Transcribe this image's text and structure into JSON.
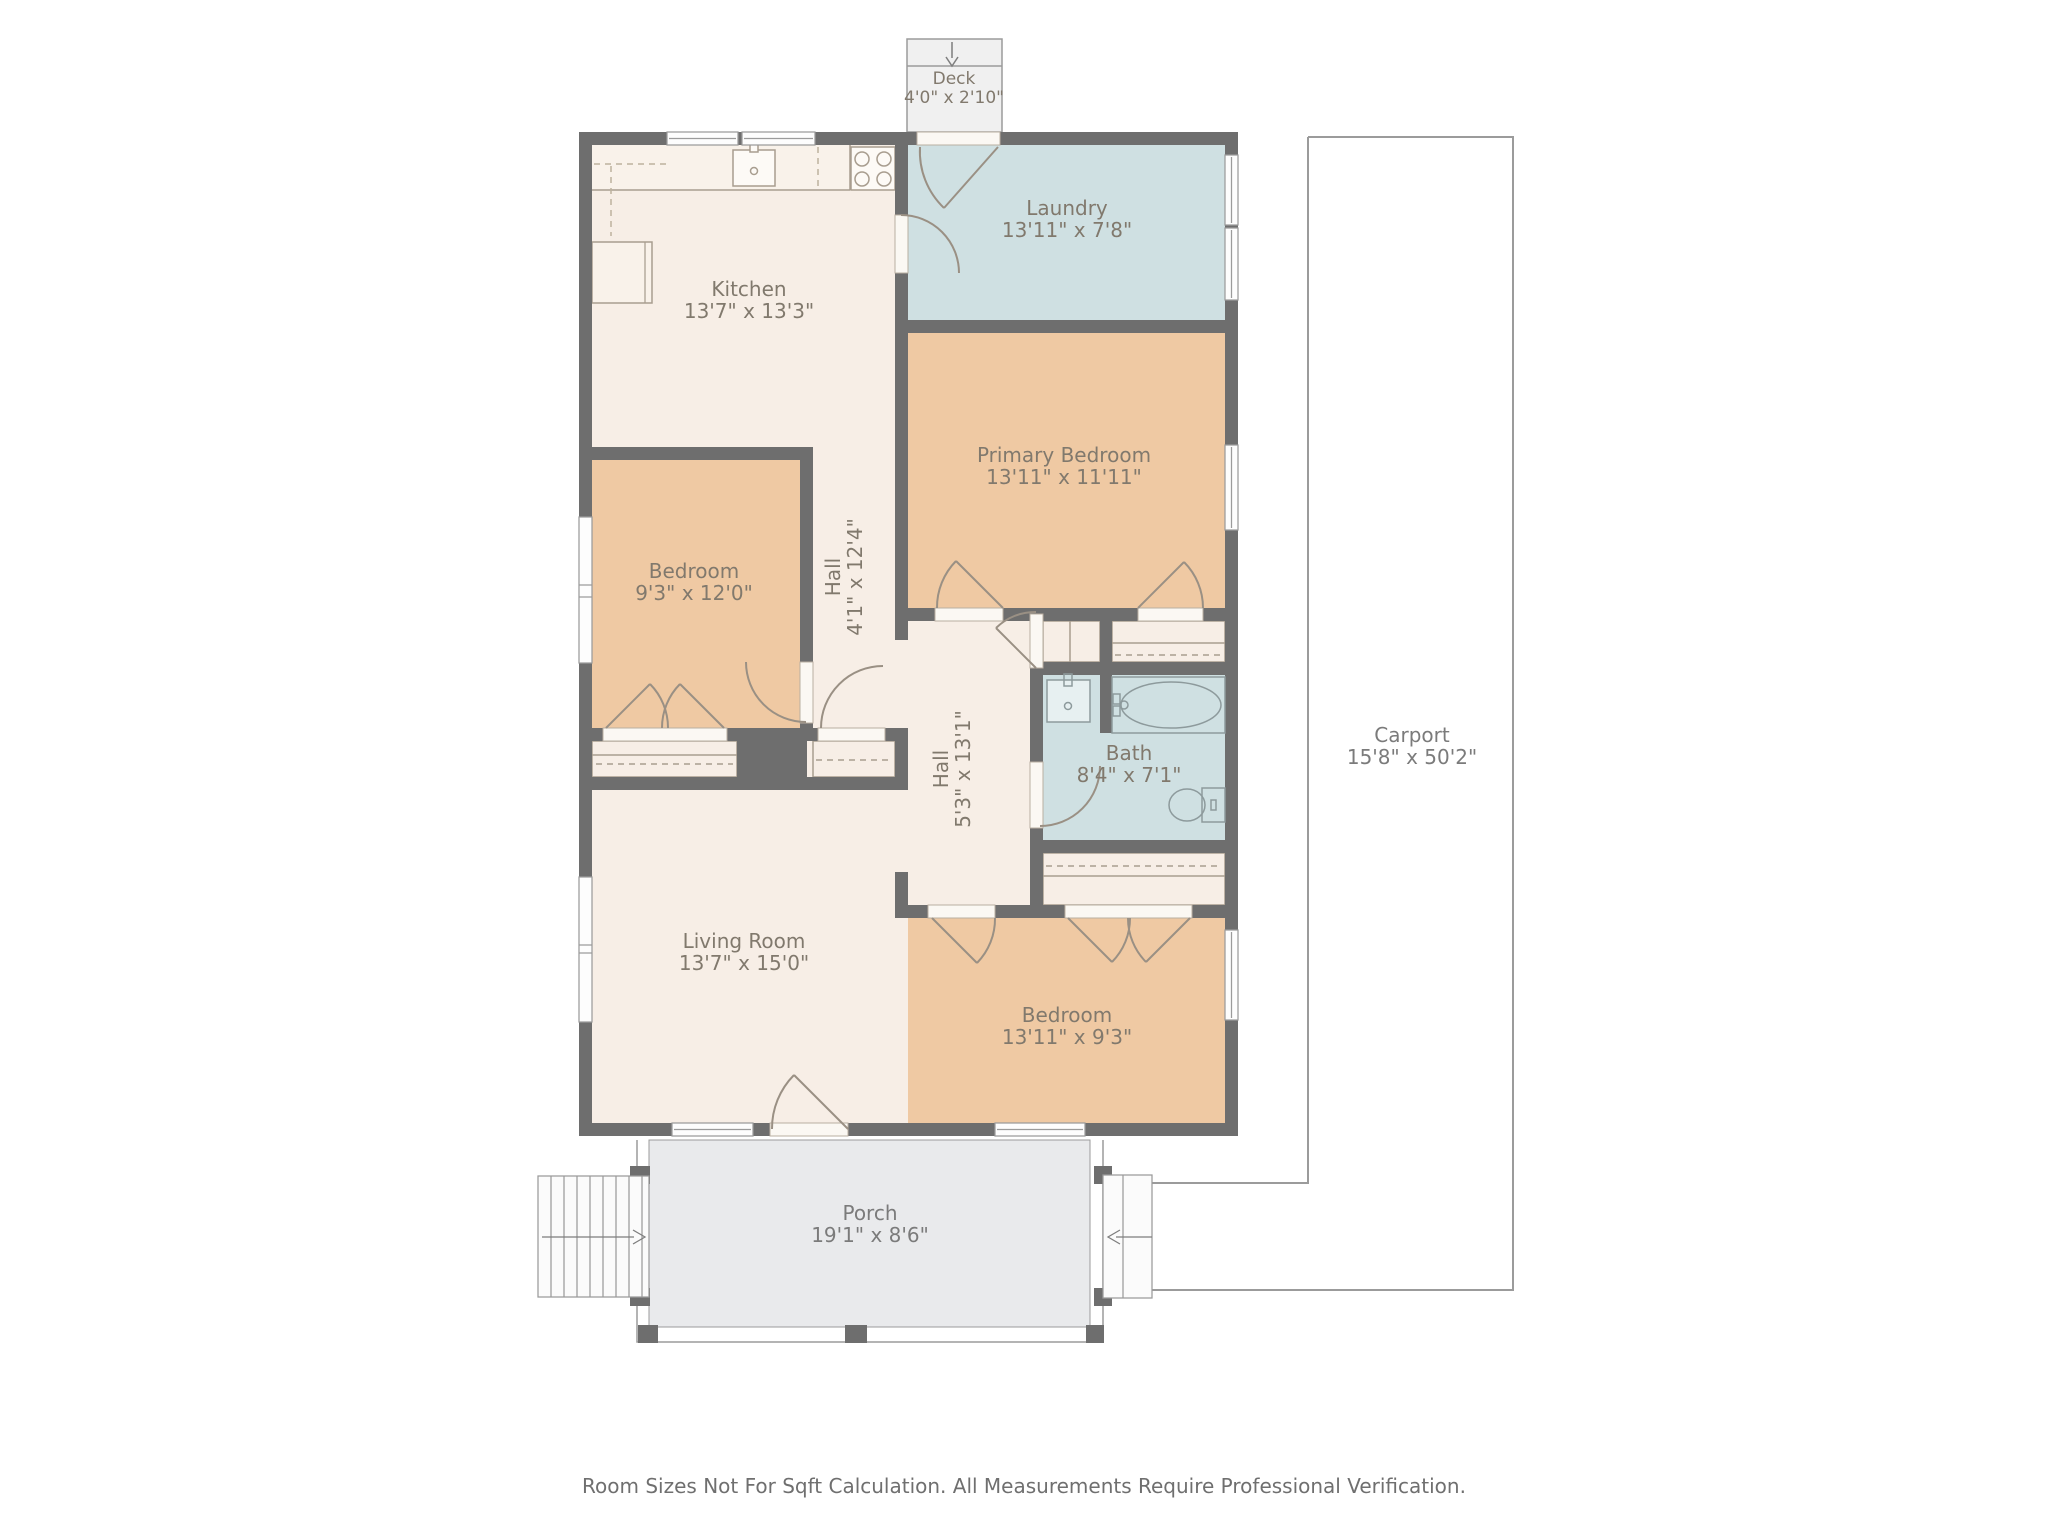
{
  "rooms": {
    "deck": {
      "name": "Deck",
      "dims": "4'0\" x 2'10\""
    },
    "laundry": {
      "name": "Laundry",
      "dims": "13'11\" x 7'8\""
    },
    "kitchen": {
      "name": "Kitchen",
      "dims": "13'7\" x 13'3\""
    },
    "primary_bedroom": {
      "name": "Primary Bedroom",
      "dims": "13'11\" x 11'11\""
    },
    "bedroom_left": {
      "name": "Bedroom",
      "dims": "9'3\" x 12'0\""
    },
    "hall_upper": {
      "name": "Hall",
      "dims": "4'1\" x 12'4\""
    },
    "hall_lower": {
      "name": "Hall",
      "dims": "5'3\" x 13'1\""
    },
    "bath": {
      "name": "Bath",
      "dims": "8'4\" x 7'1\""
    },
    "living_room": {
      "name": "Living Room",
      "dims": "13'7\" x 15'0\""
    },
    "bedroom_rear": {
      "name": "Bedroom",
      "dims": "13'11\" x 9'3\""
    },
    "porch": {
      "name": "Porch",
      "dims": "19'1\" x 8'6\""
    },
    "carport": {
      "name": "Carport",
      "dims": "15'8\" x 50'2\""
    }
  },
  "footer": {
    "disclaimer": "Room Sizes Not For Sqft Calculation. All Measurements Require Professional Verification."
  },
  "colors": {
    "wall": "#6e6e6e",
    "floor": "#f7eee6",
    "bedroom_fill": "#efc9a3",
    "wet_room_fill": "#cfe0e2",
    "porch_fill": "#e9eaec",
    "deck_fill": "#f0f0f0",
    "label_text": "#81796d"
  }
}
